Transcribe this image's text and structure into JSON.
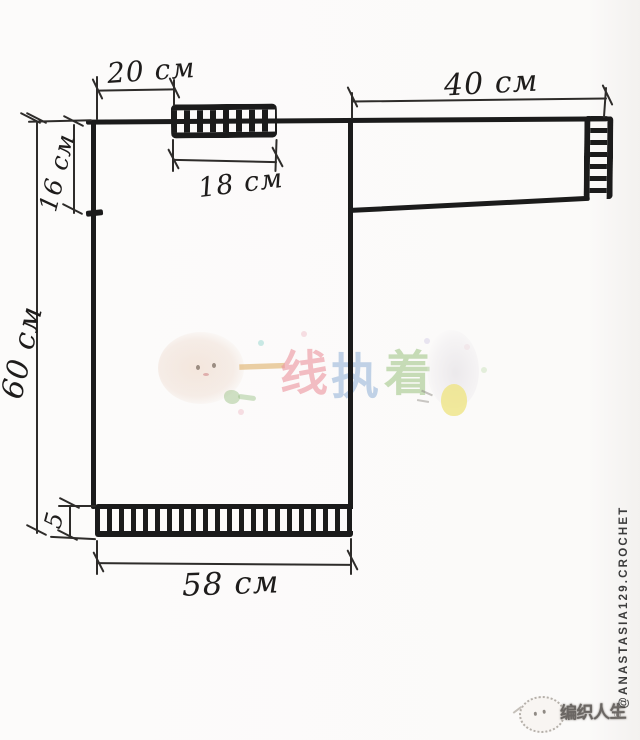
{
  "title": "Hand-drawn crochet sweater measurement schematic",
  "dimensions": {
    "shoulder_to_collar": "20 см",
    "neck_width": "18 см",
    "armhole_depth": "16 см",
    "sleeve_length": "40 см",
    "body_length": "60 см",
    "hem_rib_height": "5",
    "hem_width": "58 см"
  },
  "watermark": {
    "chars": [
      "一",
      "线",
      "执",
      "着"
    ],
    "colors": {
      "yi": "#e2b97a",
      "xian": "#ec96a0",
      "zhi": "#96b4d7",
      "zhuo": "#a5c88c"
    }
  },
  "branding": {
    "logo_text": "编织人生",
    "registered_mark": "®",
    "credit_vertical": "@ANASTASIA129.CROCHET"
  },
  "style": {
    "ink_color": "#1b1b1b",
    "paper_color": "#fbfaf9"
  }
}
